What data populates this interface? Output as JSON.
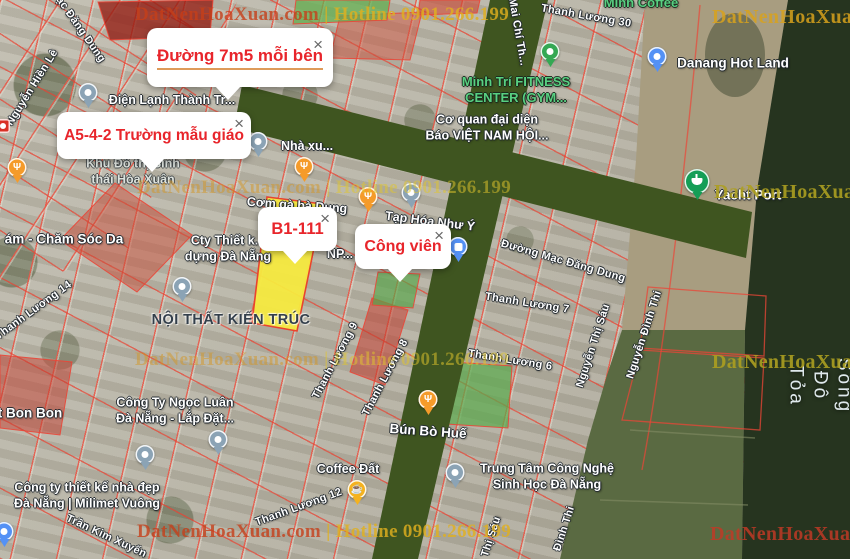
{
  "map": {
    "callouts": [
      {
        "name": "duong-7m5",
        "text": "Đường 7m5 mỗi bên",
        "close_glyph": "×"
      },
      {
        "name": "a5-4-2",
        "text": "A5-4-2 Trường mẫu giáo",
        "close_glyph": "×"
      },
      {
        "name": "b1-111",
        "text": "B1-111",
        "close_glyph": "×"
      },
      {
        "name": "cong-vien",
        "text": "Công viên",
        "close_glyph": "×"
      }
    ],
    "watermarks": [
      {
        "name": "watermark-top",
        "text": "DatNenHoaXuan.com | Hotline 0901.266.199",
        "x": 135,
        "y": 4,
        "style": "red-gold"
      },
      {
        "name": "watermark-top-right",
        "text": "DatNenHoaXua",
        "x": 712,
        "y": 6,
        "style": "gold"
      },
      {
        "name": "watermark-mid",
        "text": "DatNenHoaXuan.com | Hotline 0901.266.199",
        "x": 137,
        "y": 177,
        "style": "faint-gold"
      },
      {
        "name": "watermark-mid-right",
        "text": "DatNenHoaXua",
        "x": 714,
        "y": 181,
        "style": "olive"
      },
      {
        "name": "watermark-lower",
        "text": "DatNenHoaXuan.com | Hotline 0901.266.199",
        "x": 135,
        "y": 349,
        "style": "faint-gold"
      },
      {
        "name": "watermark-lower-right",
        "text": "DatNenHoaXua",
        "x": 712,
        "y": 351,
        "style": "olive"
      },
      {
        "name": "watermark-bottom",
        "text": "DatNenHoaXuan.com | Hotline 0901.266.199",
        "x": 137,
        "y": 521,
        "style": "red-gold"
      },
      {
        "name": "watermark-bottom-right",
        "text": "DatNenHoaXuan",
        "x": 710,
        "y": 523,
        "style": "red"
      }
    ],
    "street_labels": [
      {
        "name": "street-nguyen-hien-le",
        "text": "Nguyễn Hiền Lê",
        "x": 33,
        "y": 88,
        "rot": -58
      },
      {
        "name": "street-mac-dang-dung-top",
        "text": "ạc Đăng Dung",
        "x": 80,
        "y": 30,
        "rot": 55
      },
      {
        "name": "street-thanh-luong-30",
        "text": "Thanh Lương 30",
        "x": 586,
        "y": 17,
        "rot": 10
      },
      {
        "name": "street-mai-chi-tho",
        "text": "Mai Chí Th...",
        "x": 517,
        "y": 32,
        "rot": 80
      },
      {
        "name": "street-thanh-luong-14",
        "text": "Thanh Lương 14",
        "x": 34,
        "y": 311,
        "rot": -36
      },
      {
        "name": "street-thanh-luong-9",
        "text": "Thanh Lương 9",
        "x": 336,
        "y": 361,
        "rot": -62
      },
      {
        "name": "street-thanh-luong-8",
        "text": "Thanh Lương 8",
        "x": 386,
        "y": 378,
        "rot": -62
      },
      {
        "name": "street-thanh-luong-7",
        "text": "Thanh Lương 7",
        "x": 527,
        "y": 304,
        "rot": 9
      },
      {
        "name": "street-thanh-luong-6",
        "text": "Thanh Lương 6",
        "x": 510,
        "y": 361,
        "rot": 9
      },
      {
        "name": "street-duong-mac-dang-dung",
        "text": "Đường Mạc Đăng Dung",
        "x": 563,
        "y": 262,
        "rot": 16
      },
      {
        "name": "street-nguyen-thi-sau",
        "text": "Nguyễn Thị Sáu",
        "x": 594,
        "y": 346,
        "rot": -72
      },
      {
        "name": "street-nguyen-dinh-thi",
        "text": "Nguyễn Đình Thi",
        "x": 645,
        "y": 335,
        "rot": -72
      },
      {
        "name": "street-thanh-luong-12",
        "text": "Thanh Lương 12",
        "x": 299,
        "y": 508,
        "rot": -20
      },
      {
        "name": "street-tran-kim-xuyen",
        "text": "Trần Kim Xuyến",
        "x": 106,
        "y": 537,
        "rot": 25
      },
      {
        "name": "street-thi-sau-bottom",
        "text": "Thị Sáu",
        "x": 492,
        "y": 537,
        "rot": -72
      },
      {
        "name": "street-dinh-thi-bottom",
        "text": "Đình Thi",
        "x": 565,
        "y": 529,
        "rot": -72
      },
      {
        "name": "river-song-do-toa",
        "text": "Sông Đô Tỏa",
        "x": 820,
        "y": 386,
        "rot": 90,
        "cls": "river"
      }
    ],
    "poi_labels": [
      {
        "name": "poi-dien-lanh",
        "text": "Điện Lạnh Thành Tr...",
        "x": 172,
        "y": 101,
        "cls": "poi-white"
      },
      {
        "name": "poi-minh-tri-gym",
        "text": "Minh Trí FITNESS\nCENTER (GYM...",
        "x": 516,
        "y": 90,
        "cls": "poi-green"
      },
      {
        "name": "poi-co-quan-bao",
        "text": "Cơ quan đại diện\nBáo VIỆT NAM HỘI...",
        "x": 487,
        "y": 128,
        "cls": "poi-white"
      },
      {
        "name": "poi-danang-hot-land",
        "text": "Danang Hot Land",
        "x": 733,
        "y": 64,
        "cls": "poi-white lg"
      },
      {
        "name": "poi-yacht-port",
        "text": "Yacht Port",
        "x": 748,
        "y": 196,
        "cls": "poi-white lg"
      },
      {
        "name": "poi-minh-coffee",
        "text": "Minh Coffee",
        "x": 641,
        "y": 3,
        "cls": "poi-green"
      },
      {
        "name": "poi-khu-do-thi",
        "text": "Khu Đô thị Sinh\nthái Hòa Xuân",
        "x": 133,
        "y": 172,
        "cls": "poi-area"
      },
      {
        "name": "poi-cham-soc-da",
        "text": "ám - Chăm Sóc Da",
        "x": 64,
        "y": 240,
        "cls": "poi-white lg"
      },
      {
        "name": "poi-cty-thiet-ke",
        "text": "Cty Thiết k...\ndựng Đà Nẵng",
        "x": 228,
        "y": 249,
        "cls": "poi-white"
      },
      {
        "name": "poi-noi-that-kien-truc",
        "text": "NỘI THẤT KIẾN TRÚC",
        "x": 231,
        "y": 320,
        "cls": "poi-dark"
      },
      {
        "name": "poi-nha-xu",
        "text": "Nhà xu...",
        "x": 307,
        "y": 147,
        "cls": "poi-white"
      },
      {
        "name": "poi-com-ga-ba-dung",
        "text": "Cơm gà bà Dung",
        "x": 297,
        "y": 206,
        "rot": 4,
        "cls": "poi-white"
      },
      {
        "name": "poi-tap-hoa-nhu-y",
        "text": "Tạp Hóa Như Ý",
        "x": 430,
        "y": 222,
        "rot": 7,
        "cls": "poi-white"
      },
      {
        "name": "poi-np",
        "text": "NP...",
        "x": 340,
        "y": 255,
        "cls": "poi-white"
      },
      {
        "name": "poi-bun-bo-hue",
        "text": "Bún Bò Huế",
        "x": 428,
        "y": 432,
        "rot": 4,
        "cls": "poi-white lg"
      },
      {
        "name": "poi-ngoc-luan",
        "text": "Công Ty Ngọc Luân\nĐà Nẵng - Lắp Đặt...",
        "x": 175,
        "y": 411,
        "cls": "poi-white"
      },
      {
        "name": "poi-milimet-vuong",
        "text": "Công ty thiết kế nhà đẹp\nĐà Nẵng | Milimet Vuông",
        "x": 87,
        "y": 496,
        "cls": "poi-white"
      },
      {
        "name": "poi-bon-bon",
        "text": "t Bon Bon",
        "x": 30,
        "y": 414,
        "cls": "poi-white lg"
      },
      {
        "name": "poi-coffee-dat",
        "text": "Coffee Đất",
        "x": 348,
        "y": 470,
        "cls": "poi-white"
      },
      {
        "name": "poi-trung-tam-cnsh",
        "text": "Trung Tâm Công Nghệ\nSinh Học Đà Nẵng",
        "x": 547,
        "y": 477,
        "cls": "poi-white"
      }
    ],
    "pins": [
      {
        "name": "poi-pin-dien-lanh",
        "x": 88,
        "y": 113,
        "color": "#8ba3b5"
      },
      {
        "name": "poi-pin-restaurant-left",
        "x": 17,
        "y": 188,
        "color": "#f59b2a",
        "glyph": "Ψ"
      },
      {
        "name": "poi-pin-restaurant-com-ga",
        "x": 304,
        "y": 187,
        "color": "#f59b2a",
        "glyph": "Ψ"
      },
      {
        "name": "poi-pin-restaurant-tap-hoa",
        "x": 368,
        "y": 217,
        "color": "#f59b2a",
        "glyph": "Ψ"
      },
      {
        "name": "poi-pin-restaurant-bun-bo",
        "x": 428,
        "y": 420,
        "color": "#f59b2a",
        "glyph": "Ψ"
      },
      {
        "name": "poi-pin-coffee-dat",
        "x": 357,
        "y": 510,
        "color": "#f4b21f",
        "glyph": "☕"
      },
      {
        "name": "poi-pin-minh-tri",
        "x": 550,
        "y": 72,
        "color": "#34a853"
      },
      {
        "name": "poi-pin-danang-hot-land",
        "x": 657,
        "y": 77,
        "color": "#5491f5"
      },
      {
        "name": "poi-pin-yacht-port",
        "x": 697,
        "y": 205,
        "color": "#149e56",
        "shape": "ship",
        "size": 25
      },
      {
        "name": "poi-pin-nha-xe",
        "x": 258,
        "y": 162,
        "color": "#8ba3b5"
      },
      {
        "name": "poi-pin-tap-hoa-blue",
        "x": 411,
        "y": 213,
        "color": "#8ba3b5"
      },
      {
        "name": "poi-pin-shopping-bag",
        "x": 458,
        "y": 267,
        "color": "#5491f5",
        "shape": "bag"
      },
      {
        "name": "poi-pin-noi-that",
        "x": 182,
        "y": 307,
        "color": "#8ba3b5"
      },
      {
        "name": "poi-pin-ngoc-luan-1",
        "x": 145,
        "y": 475,
        "color": "#8ba3b5"
      },
      {
        "name": "poi-pin-ngoc-luan-2",
        "x": 218,
        "y": 460,
        "color": "#8ba3b5"
      },
      {
        "name": "poi-pin-trung-tam",
        "x": 455,
        "y": 493,
        "color": "#8ba3b5"
      },
      {
        "name": "poi-pin-bottom-left",
        "x": 4,
        "y": 552,
        "color": "#5491f5"
      },
      {
        "name": "poi-icon-shop-left",
        "x": 3,
        "y": 126,
        "color": "#d93025",
        "shape": "square"
      }
    ]
  }
}
